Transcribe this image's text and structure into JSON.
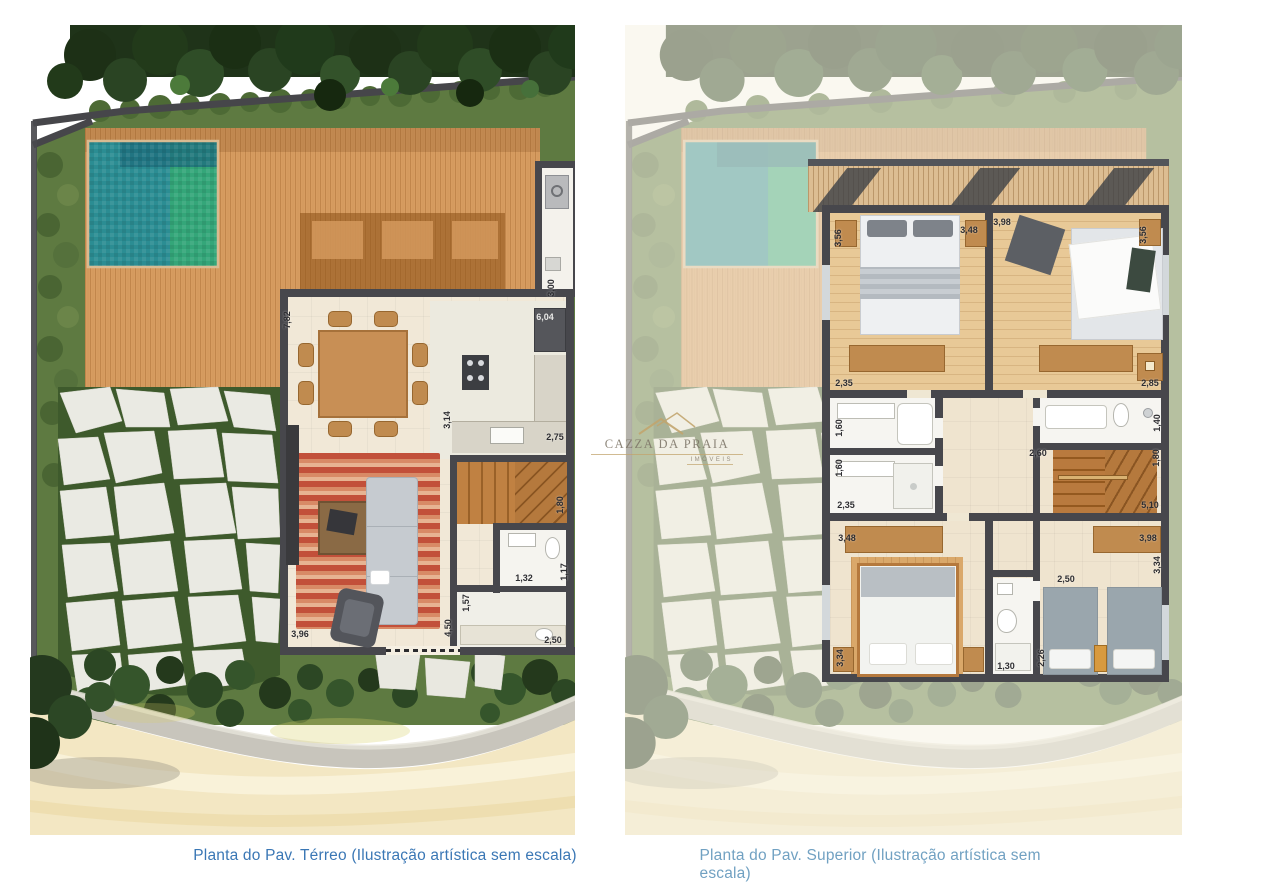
{
  "watermark": {
    "brand": "CAZZA DA PRAIA",
    "subtitle": "IMÓVEIS"
  },
  "panels": {
    "terreo": {
      "caption": "Planta do Pav. Térreo (Ilustração artística sem escala)",
      "dims": [
        "7,82",
        "3,00",
        "6,04",
        "3,14",
        "2,75",
        "1,80",
        "1,32",
        "1,17",
        "1,57",
        "4,50",
        "3,96",
        "2,50"
      ]
    },
    "superior": {
      "caption": "Planta do Pav. Superior (Ilustração artística sem escala)",
      "dims": [
        "3,56",
        "3,48",
        "3,98",
        "3,56",
        "2,35",
        "2,85",
        "1,60",
        "1,40",
        "2,60",
        "1,80",
        "1,60",
        "2,35",
        "5,10",
        "3,48",
        "3,98",
        "3,34",
        "2,50",
        "3,34",
        "1,30",
        "2,26"
      ]
    }
  },
  "colors": {
    "caption_terreo": "#3a77b5",
    "caption_superior": "#71a1c2",
    "pool_teal": "#2b8d93",
    "pool_green": "#35a877",
    "deck_wood": "#d79c60",
    "wall": "#47474c",
    "watermark_gold": "#c2a56d",
    "watermark_text": "#7e7668"
  }
}
